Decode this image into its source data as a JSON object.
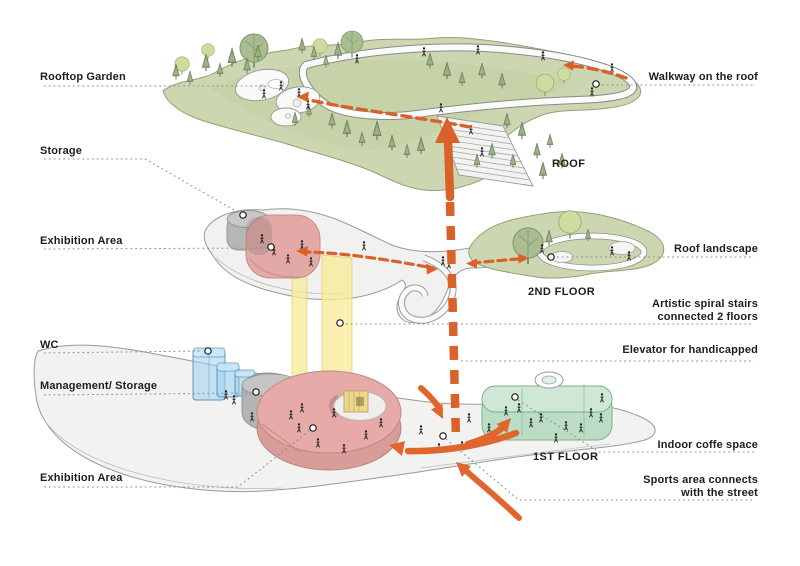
{
  "diagram": {
    "title": "Exploded axonometric circulation diagram",
    "left_labels": [
      {
        "id": "rooftop-garden",
        "label": "Rooftop Garden"
      },
      {
        "id": "storage",
        "label": "Storage"
      },
      {
        "id": "exhibition-area-2f",
        "label": "Exhibition Area"
      },
      {
        "id": "wc",
        "label": "WC"
      },
      {
        "id": "management-storage",
        "label": "Management/ Storage"
      },
      {
        "id": "exhibition-area-1f",
        "label": "Exhibition Area"
      }
    ],
    "right_labels": [
      {
        "id": "walkway-on-the-roof",
        "label": "Walkway on the roof"
      },
      {
        "id": "roof-landscape",
        "label": "Roof landscape"
      },
      {
        "id": "artistic-spiral-stairs",
        "line1": "Artistic spiral stairs",
        "line2": "connected 2 floors"
      },
      {
        "id": "elevator-handicapped",
        "label": "Elevator for handicapped"
      },
      {
        "id": "indoor-coffe-space",
        "label": "Indoor coffe space"
      },
      {
        "id": "sports-area",
        "line1": "Sports area connects",
        "line2": "with the street"
      }
    ],
    "floor_labels": [
      {
        "id": "roof",
        "label": "ROOF"
      },
      {
        "id": "2nd-floor",
        "label": "2ND FLOOR"
      },
      {
        "id": "1st-floor",
        "label": "1ST FLOOR"
      }
    ],
    "colors": {
      "circulation_orange": "#de6329",
      "exhibition_pink": "#e5aaa7",
      "storage_gray": "#b3b3b3",
      "wc_blue": "#9ed0ee",
      "coffe_green": "#b9dcc3",
      "stairs_yellow": "#f7ea99",
      "roof_green": "#ccd7b2",
      "leader_gray": "#8c8c8c",
      "text_dark": "#1d1d1b"
    }
  }
}
